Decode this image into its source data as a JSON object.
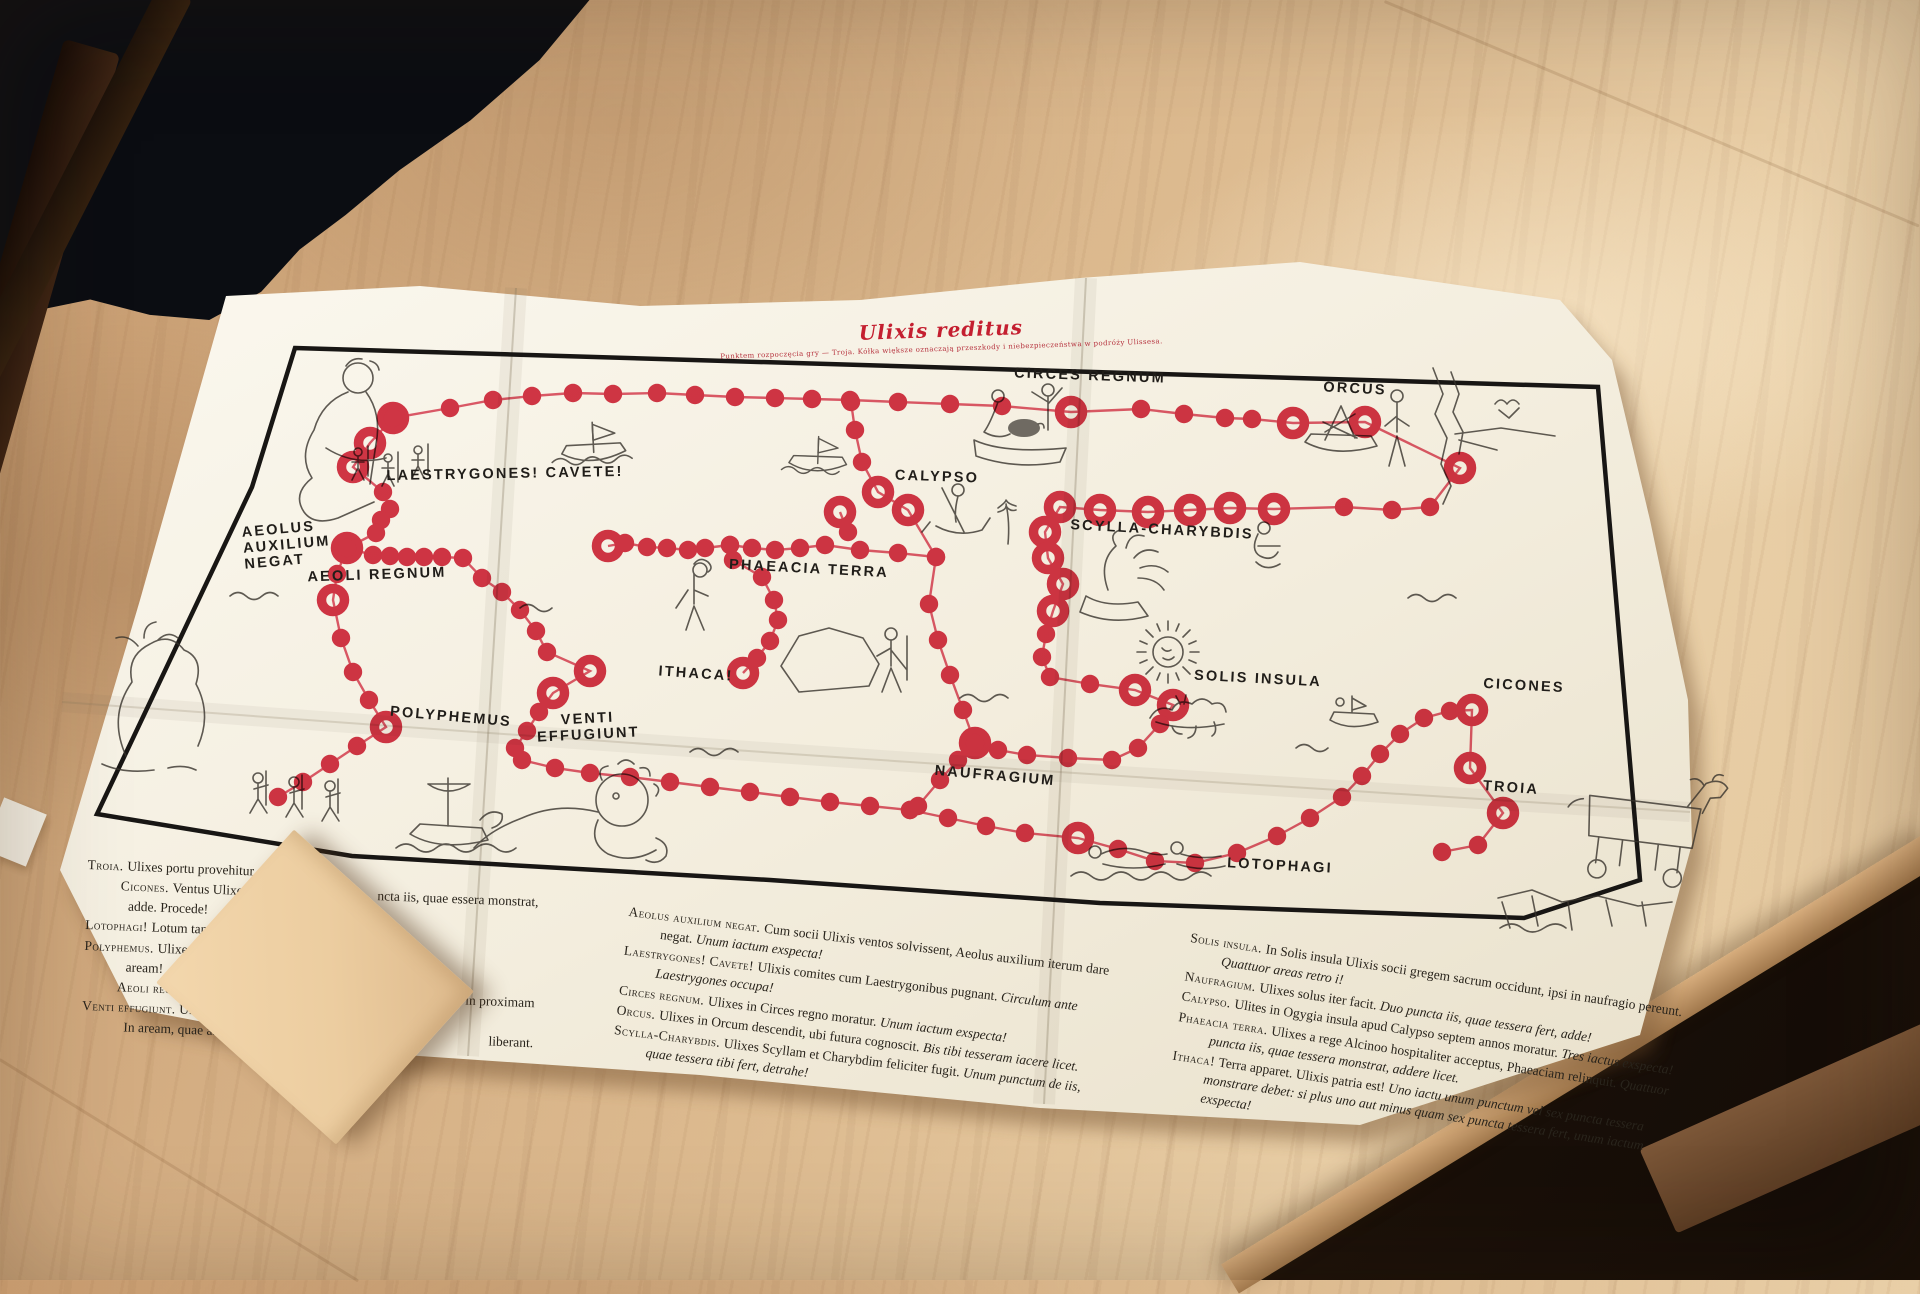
{
  "board": {
    "title": "Ulixis reditus",
    "subtitle": "Punktem rozpoczęcia gry — Troja. Kółka większe oznaczają przeszkody i niebezpieczeństwa w podróży Ulissesa.",
    "accent_color": "#c41f30",
    "path_color": "#d2293e",
    "stations": [
      {
        "id": "laestrygones",
        "label": "LAESTRYGONES! CAVETE!",
        "x": 505,
        "y": 474,
        "rot": -1
      },
      {
        "id": "circes-regnum",
        "label": "CIRCES REGNUM",
        "x": 1090,
        "y": 376,
        "rot": 2
      },
      {
        "id": "orcus",
        "label": "ORCUS",
        "x": 1355,
        "y": 389,
        "rot": 3
      },
      {
        "id": "aeolus-auxilium-negat",
        "label": "AEOLUS\nAUXILIUM\nNEGAT",
        "x": 243,
        "y": 545,
        "rot": -5,
        "align": "left"
      },
      {
        "id": "aeoli-regnum",
        "label": "AEOLI REGNUM",
        "x": 377,
        "y": 575,
        "rot": -2
      },
      {
        "id": "calypso",
        "label": "CALYPSO",
        "x": 937,
        "y": 477,
        "rot": 2
      },
      {
        "id": "scylla-charybdis",
        "label": "SCYLLA-CHARYBDIS",
        "x": 1162,
        "y": 530,
        "rot": 3
      },
      {
        "id": "phaeacia-terra",
        "label": "PHAEACIA TERRA",
        "x": 809,
        "y": 569,
        "rot": 3
      },
      {
        "id": "ithaca",
        "label": "ITHACA!",
        "x": 696,
        "y": 674,
        "rot": 4
      },
      {
        "id": "venti-effugiunt",
        "label": "VENTI\nEFFUGIUNT",
        "x": 588,
        "y": 727,
        "rot": -3
      },
      {
        "id": "polyphemus",
        "label": "POLYPHEMUS",
        "x": 451,
        "y": 717,
        "rot": 5
      },
      {
        "id": "naufragium",
        "label": "NAUFRAGIUM",
        "x": 995,
        "y": 776,
        "rot": 5
      },
      {
        "id": "solis-insula",
        "label": "SOLIS INSULA",
        "x": 1258,
        "y": 679,
        "rot": 3
      },
      {
        "id": "cicones",
        "label": "CICONES",
        "x": 1524,
        "y": 686,
        "rot": 3
      },
      {
        "id": "troia",
        "label": "TROIA",
        "x": 1511,
        "y": 788,
        "rot": 4
      },
      {
        "id": "lotophagi",
        "label": "LOTOPHAGI",
        "x": 1280,
        "y": 866,
        "rot": 3
      }
    ],
    "path_segments": [
      [
        [
          393,
          418,
          1
        ],
        [
          450,
          408,
          0
        ],
        [
          493,
          400,
          0
        ],
        [
          532,
          396,
          0
        ],
        [
          573,
          393,
          0
        ],
        [
          613,
          394,
          0
        ],
        [
          657,
          393,
          0
        ],
        [
          695,
          395,
          0
        ],
        [
          735,
          397,
          0
        ],
        [
          775,
          398,
          0
        ],
        [
          812,
          399,
          0
        ],
        [
          850,
          400,
          0
        ],
        [
          898,
          402,
          0
        ],
        [
          950,
          404,
          0
        ],
        [
          1002,
          406,
          0
        ],
        [
          1071,
          412,
          1
        ],
        [
          1141,
          409,
          0
        ],
        [
          1184,
          414,
          0
        ],
        [
          1225,
          418,
          0
        ],
        [
          1252,
          419,
          0
        ],
        [
          1293,
          423,
          1
        ],
        [
          1365,
          422,
          1
        ],
        [
          1460,
          468,
          1
        ],
        [
          1430,
          507,
          0
        ],
        [
          1392,
          510,
          0
        ],
        [
          1344,
          507,
          0
        ],
        [
          1274,
          509,
          1
        ],
        [
          1230,
          508,
          1
        ],
        [
          1190,
          510,
          1
        ],
        [
          1148,
          512,
          1
        ],
        [
          1100,
          510,
          1
        ],
        [
          1060,
          507,
          1
        ],
        [
          1045,
          532,
          1
        ],
        [
          1048,
          558,
          1
        ],
        [
          1063,
          584,
          1
        ],
        [
          1053,
          611,
          1
        ],
        [
          1046,
          634,
          0
        ],
        [
          1042,
          657,
          0
        ],
        [
          1050,
          677,
          0
        ],
        [
          1090,
          684,
          0
        ],
        [
          1135,
          690,
          1
        ],
        [
          1173,
          705,
          1
        ],
        [
          1160,
          724,
          0
        ],
        [
          1138,
          748,
          0
        ],
        [
          1112,
          760,
          0
        ],
        [
          1068,
          758,
          0
        ],
        [
          1027,
          755,
          0
        ],
        [
          998,
          750,
          0
        ],
        [
          975,
          743,
          1
        ]
      ],
      [
        [
          975,
          743,
          0
        ],
        [
          963,
          710,
          0
        ],
        [
          950,
          675,
          0
        ],
        [
          938,
          640,
          0
        ],
        [
          929,
          604,
          0
        ],
        [
          936,
          557,
          0
        ],
        [
          908,
          510,
          1
        ],
        [
          878,
          492,
          1
        ],
        [
          862,
          462,
          0
        ],
        [
          855,
          430,
          0
        ],
        [
          851,
          402,
          0
        ]
      ],
      [
        [
          936,
          557,
          0
        ],
        [
          898,
          553,
          0
        ],
        [
          860,
          550,
          0
        ],
        [
          825,
          545,
          0
        ],
        [
          800,
          548,
          0
        ],
        [
          775,
          550,
          0
        ],
        [
          752,
          548,
          0
        ],
        [
          730,
          545,
          0
        ],
        [
          705,
          548,
          0
        ],
        [
          688,
          550,
          0
        ],
        [
          667,
          548,
          0
        ],
        [
          647,
          547,
          0
        ],
        [
          625,
          543,
          0
        ],
        [
          608,
          546,
          1
        ]
      ],
      [
        [
          730,
          545,
          0
        ],
        [
          733,
          560,
          0
        ],
        [
          762,
          577,
          0
        ],
        [
          774,
          600,
          0
        ],
        [
          778,
          620,
          0
        ],
        [
          770,
          641,
          0
        ],
        [
          757,
          658,
          0
        ],
        [
          743,
          673,
          1
        ]
      ],
      [
        [
          393,
          418,
          0
        ],
        [
          370,
          443,
          1
        ],
        [
          353,
          467,
          1
        ],
        [
          383,
          492,
          0
        ],
        [
          390,
          509,
          0
        ],
        [
          381,
          520,
          0
        ],
        [
          376,
          533,
          0
        ],
        [
          347,
          548,
          1
        ],
        [
          373,
          555,
          0
        ],
        [
          390,
          556,
          0
        ],
        [
          407,
          557,
          0
        ],
        [
          424,
          557,
          0
        ],
        [
          442,
          557,
          0
        ],
        [
          463,
          558,
          0
        ],
        [
          482,
          578,
          0
        ],
        [
          502,
          592,
          0
        ],
        [
          520,
          610,
          0
        ],
        [
          536,
          631,
          0
        ],
        [
          547,
          652,
          0
        ],
        [
          590,
          671,
          1
        ],
        [
          553,
          693,
          1
        ],
        [
          539,
          712,
          0
        ],
        [
          527,
          731,
          0
        ],
        [
          515,
          748,
          0
        ],
        [
          522,
          760,
          0
        ],
        [
          555,
          768,
          0
        ],
        [
          590,
          773,
          0
        ],
        [
          630,
          777,
          0
        ],
        [
          670,
          782,
          0
        ],
        [
          710,
          787,
          0
        ],
        [
          750,
          792,
          0
        ],
        [
          790,
          797,
          0
        ],
        [
          830,
          802,
          0
        ],
        [
          870,
          806,
          0
        ],
        [
          910,
          810,
          0
        ]
      ],
      [
        [
          910,
          810,
          0
        ],
        [
          948,
          818,
          0
        ],
        [
          986,
          826,
          0
        ],
        [
          1025,
          833,
          0
        ],
        [
          1078,
          838,
          1
        ],
        [
          1118,
          849,
          0
        ],
        [
          1155,
          861,
          0
        ],
        [
          1195,
          863,
          0
        ],
        [
          1237,
          853,
          0
        ],
        [
          1277,
          836,
          0
        ],
        [
          1310,
          818,
          0
        ],
        [
          1342,
          797,
          0
        ],
        [
          1362,
          776,
          0
        ],
        [
          1380,
          754,
          0
        ],
        [
          1400,
          734,
          0
        ],
        [
          1424,
          718,
          0
        ],
        [
          1450,
          711,
          0
        ],
        [
          1472,
          710,
          1
        ],
        [
          1470,
          768,
          1
        ],
        [
          1503,
          813,
          1
        ],
        [
          1478,
          845,
          0
        ],
        [
          1442,
          852,
          0
        ]
      ],
      [
        [
          918,
          806,
          0
        ],
        [
          940,
          780,
          0
        ],
        [
          958,
          760,
          0
        ],
        [
          975,
          743,
          0
        ]
      ],
      [
        [
          347,
          548,
          0
        ],
        [
          337,
          574,
          0
        ],
        [
          333,
          600,
          1
        ],
        [
          341,
          638,
          0
        ],
        [
          353,
          672,
          0
        ],
        [
          369,
          700,
          0
        ],
        [
          386,
          727,
          1
        ],
        [
          357,
          746,
          0
        ],
        [
          330,
          764,
          0
        ],
        [
          303,
          782,
          0
        ],
        [
          278,
          797,
          0
        ]
      ],
      [
        [
          840,
          512,
          1
        ],
        [
          848,
          532,
          0
        ]
      ]
    ],
    "rules_left": [
      {
        "term": "Troia.",
        "left": "Ulixes portu provehitur."
      },
      {
        "term": "Cicones.",
        "left": "Ventus Ulixem ad Cicōnes detulit.",
        "right": "ncta iis, quae essera monstrat,"
      },
      {
        "left": "adde. Procede!",
        "indent": true
      },
      {
        "term": "Lotophagi!",
        "left": "Lotum tangere noli! Un"
      },
      {
        "term": "Polyphemus.",
        "left": "Ulixes Polyphemum"
      },
      {
        "left": "aream!",
        "indent": true
      },
      {
        "term": "Aeoli regnum.",
        "left": "Circulum prim",
        "right": "Redi in proximam"
      },
      {
        "term": "Venti effugiunt.",
        "left": "Ulixis soc"
      },
      {
        "left": "In aream, quae ante",
        "right": "liberant.",
        "indent": true
      }
    ],
    "rules_middle": [
      {
        "term": "Aeolus auxilium negat.",
        "text": "Cum socii Ulixis ventos solvissent, Aeolus auxilium iterum dare negat.",
        "cmd": "Unum iactum exspecta!"
      },
      {
        "term": "Laestrygones! Cavete!",
        "text": "Ulixis comites cum Laestrygonibus pugnant.",
        "cmd": "Circulum ante Laestrygones occupa!"
      },
      {
        "term": "Circes regnum.",
        "text": "Ulixes in Circes regno moratur.",
        "cmd": "Unum iactum exspecta!"
      },
      {
        "term": "Orcus.",
        "text": "Ulixes in Orcum descendit, ubi futura cognoscit.",
        "cmd": "Bis tibi tesseram iacere licet."
      },
      {
        "term": "Scylla-Charybdis.",
        "text": "Ulixes Scyllam et Charybdim feliciter fugit.",
        "cmd": "Unum punctum de iis, quae tessera tibi fert, detrahe!"
      }
    ],
    "rules_right": [
      {
        "term": "Solis insula.",
        "text": "In Solis insula Ulixis socii gregem sacrum occidunt, ipsi in naufragio pereunt.",
        "cmd": "Quattuor areas retro i!"
      },
      {
        "term": "Naufragium.",
        "text": "Ulixes solus iter facit.",
        "cmd": "Duo puncta iis, quae tessera fert, adde!"
      },
      {
        "term": "Calypso.",
        "text": "Ulites in Ogygia insula apud Calypso septem annos moratur.",
        "cmd": "Tres iactus exspecta!"
      },
      {
        "term": "Phaeacia terra.",
        "text": "Ulixes a rege Alcinoo hospitaliter acceptus, Phaeaciam relinquit.",
        "cmd": "Quattuor puncta iis, quae tessera monstrat, addere licet."
      },
      {
        "term": "Ithaca!",
        "text": "Terra apparet. Ulixis patria est!",
        "cmd": "Uno iactu unum punctum vel sex puncta tessera monstrare debet: si plus uno aut minus quam sex puncta tessera fert, unum iactum exspecta!"
      }
    ]
  }
}
